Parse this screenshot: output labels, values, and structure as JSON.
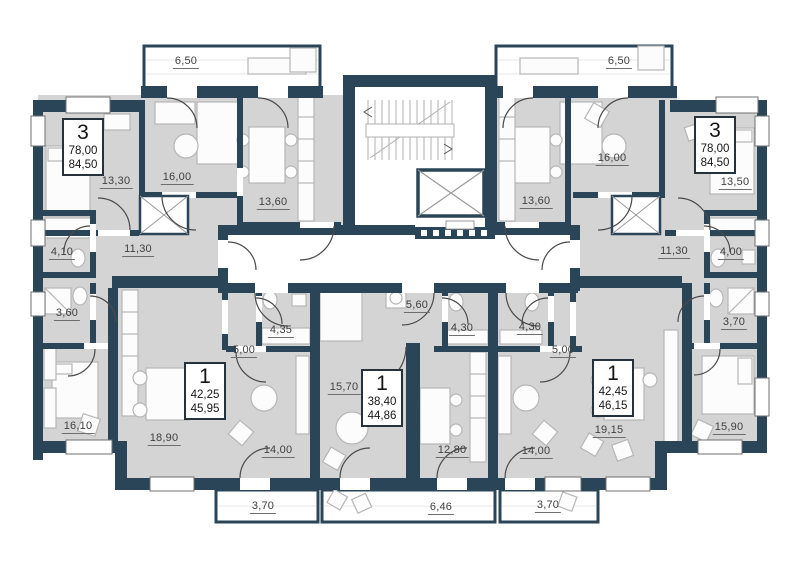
{
  "plan_name": "residential-floor-plan",
  "colors": {
    "wall": "#2a4557",
    "room_fill": "#d4d4d4",
    "common_area": "#ffffff",
    "furniture_line": "#b6b6b6",
    "label_text": "#3f3f3f"
  },
  "apartments": [
    {
      "pos": "top-left",
      "type": "3",
      "area1": "78,00",
      "area2": "84,50"
    },
    {
      "pos": "top-right",
      "type": "3",
      "area1": "78,00",
      "area2": "84,50"
    },
    {
      "pos": "bottom-left",
      "type": "1",
      "area1": "42,25",
      "area2": "45,95"
    },
    {
      "pos": "bottom-center",
      "type": "1",
      "area1": "38,40",
      "area2": "44,86"
    },
    {
      "pos": "bottom-right",
      "type": "1",
      "area1": "42,45",
      "area2": "46,15"
    }
  ],
  "room_labels": [
    {
      "text": "6,50"
    },
    {
      "text": "13,30"
    },
    {
      "text": "16,00"
    },
    {
      "text": "13,60"
    },
    {
      "text": "4,10"
    },
    {
      "text": "11,30"
    },
    {
      "text": "3,60"
    },
    {
      "text": "16,10"
    },
    {
      "text": "18,90"
    },
    {
      "text": "5,00"
    },
    {
      "text": "4,35"
    },
    {
      "text": "14,00"
    },
    {
      "text": "3,70"
    },
    {
      "text": "15,70"
    },
    {
      "text": "5,60"
    },
    {
      "text": "4,30"
    },
    {
      "text": "12,80"
    },
    {
      "text": "6,46"
    },
    {
      "text": "4,30"
    },
    {
      "text": "5,00"
    },
    {
      "text": "14,00"
    },
    {
      "text": "3,70"
    },
    {
      "text": "19,15"
    },
    {
      "text": "15,90"
    },
    {
      "text": "3,70"
    },
    {
      "text": "4,00"
    },
    {
      "text": "11,30"
    },
    {
      "text": "13,50"
    },
    {
      "text": "16,00"
    },
    {
      "text": "13,60"
    },
    {
      "text": "6,50"
    }
  ]
}
